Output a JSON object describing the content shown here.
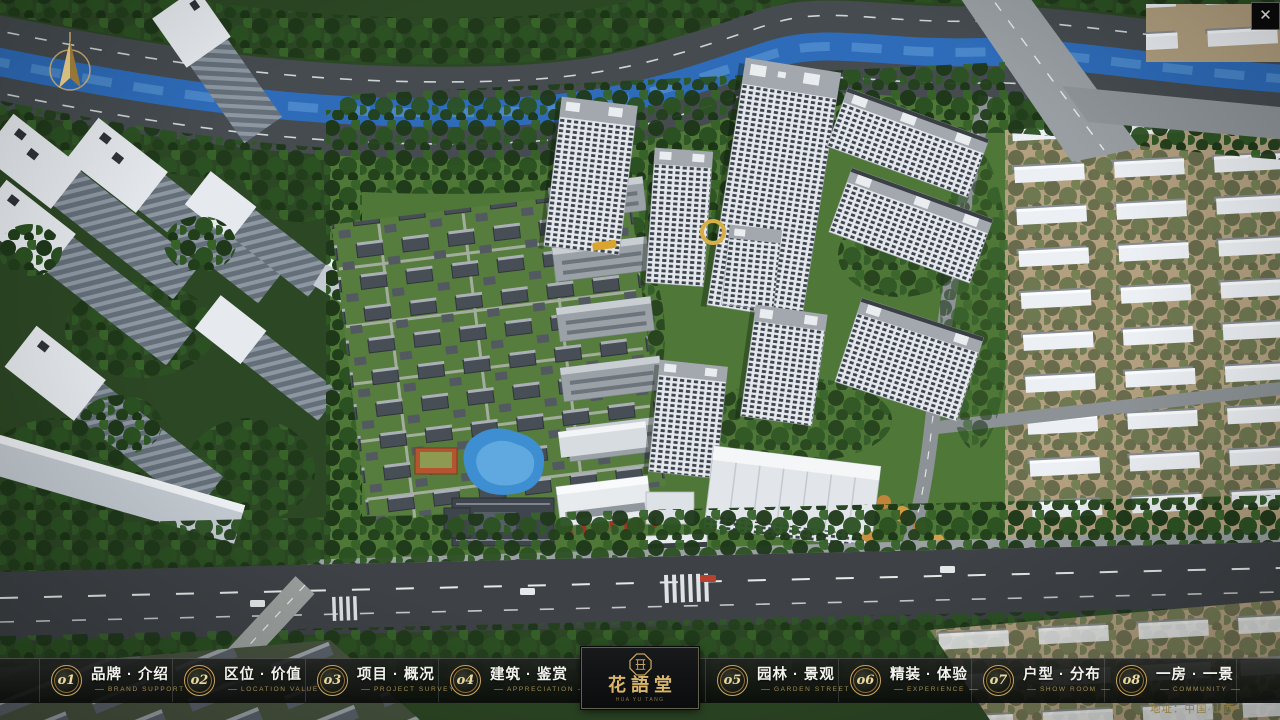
{
  "app": {
    "close_glyph": "✕"
  },
  "nav": {
    "items": [
      {
        "num": "o1",
        "zh": "品牌 · 介绍",
        "en": "BRAND SUPPORT"
      },
      {
        "num": "o2",
        "zh": "区位 · 价值",
        "en": "LOCATION VALUE"
      },
      {
        "num": "o3",
        "zh": "项目 · 概况",
        "en": "PROJECT SURVEY"
      },
      {
        "num": "o4",
        "zh": "建筑 · 鉴赏",
        "en": "APPRECIATION"
      },
      {
        "num": "o5",
        "zh": "园林 · 景观",
        "en": "GARDEN STREET"
      },
      {
        "num": "o6",
        "zh": "精装 · 体验",
        "en": "EXPERIENCE"
      },
      {
        "num": "o7",
        "zh": "户型 · 分布",
        "en": "SHOW ROOM"
      },
      {
        "num": "o8",
        "zh": "一房 · 一景",
        "en": "COMMUNITY"
      }
    ],
    "logo": {
      "name": "花語堂",
      "subtitle": "HUA YU TANG"
    }
  },
  "footer": {
    "address": "地址：中国·山西"
  },
  "colors": {
    "accent_gold": "#c9a35e",
    "nav_bg": "rgba(10,12,10,0.88)",
    "river_blue": "#2e6cba"
  }
}
